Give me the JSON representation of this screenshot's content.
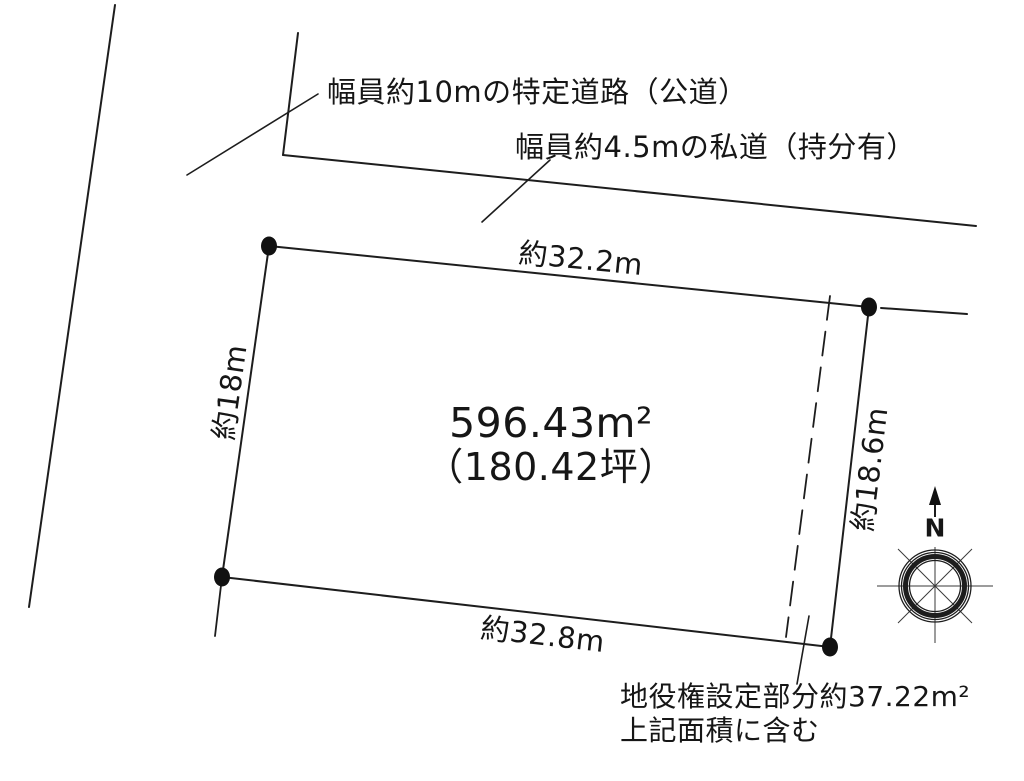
{
  "page": {
    "title": "土地区画図",
    "width_px": 1024,
    "height_px": 781
  },
  "colors": {
    "ink": "#1d1d1d",
    "paper": "#ffffff"
  },
  "roads": {
    "public_label": "幅員約10mの特定道路（公道）",
    "private_label": "幅員約4.5mの私道（持分有）"
  },
  "parcel": {
    "area_label": "596.43m²",
    "area_tsubo_label": "（180.42坪）",
    "edge_top_label": "約32.2m",
    "edge_bottom_label": "約32.8m",
    "edge_left_label": "約18m",
    "edge_right_label": "約18.6m"
  },
  "easement": {
    "line1": "地役権設定部分約37.22m²",
    "line2": "上記面積に含む"
  },
  "compass": {
    "north_label": "N"
  }
}
